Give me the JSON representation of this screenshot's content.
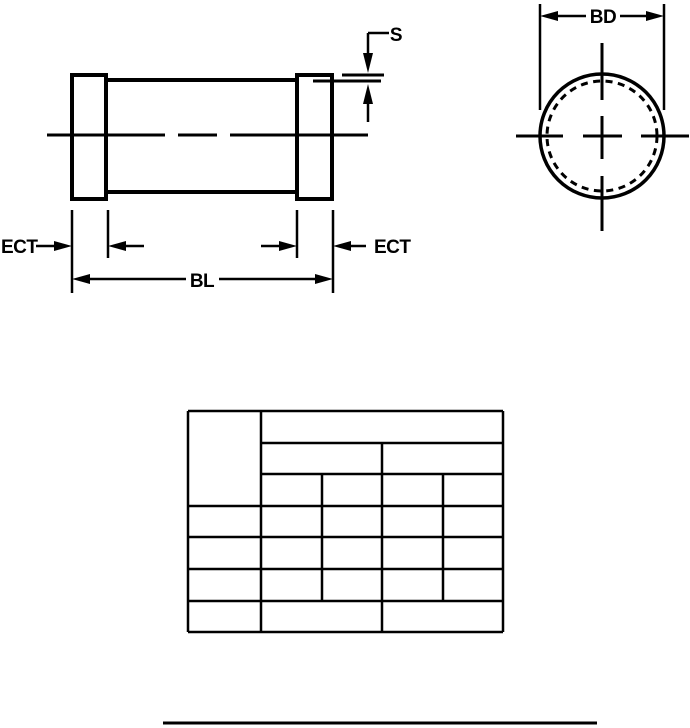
{
  "figure": {
    "side_view": {
      "s_label": "S",
      "ect_left_label": "ECT",
      "ect_right_label": "ECT",
      "bl_label": "BL"
    },
    "end_view": {
      "bd_label": "BD"
    },
    "table": {
      "cells_text": []
    },
    "colors": {
      "ink": "#000000",
      "paper": "#ffffff"
    }
  }
}
